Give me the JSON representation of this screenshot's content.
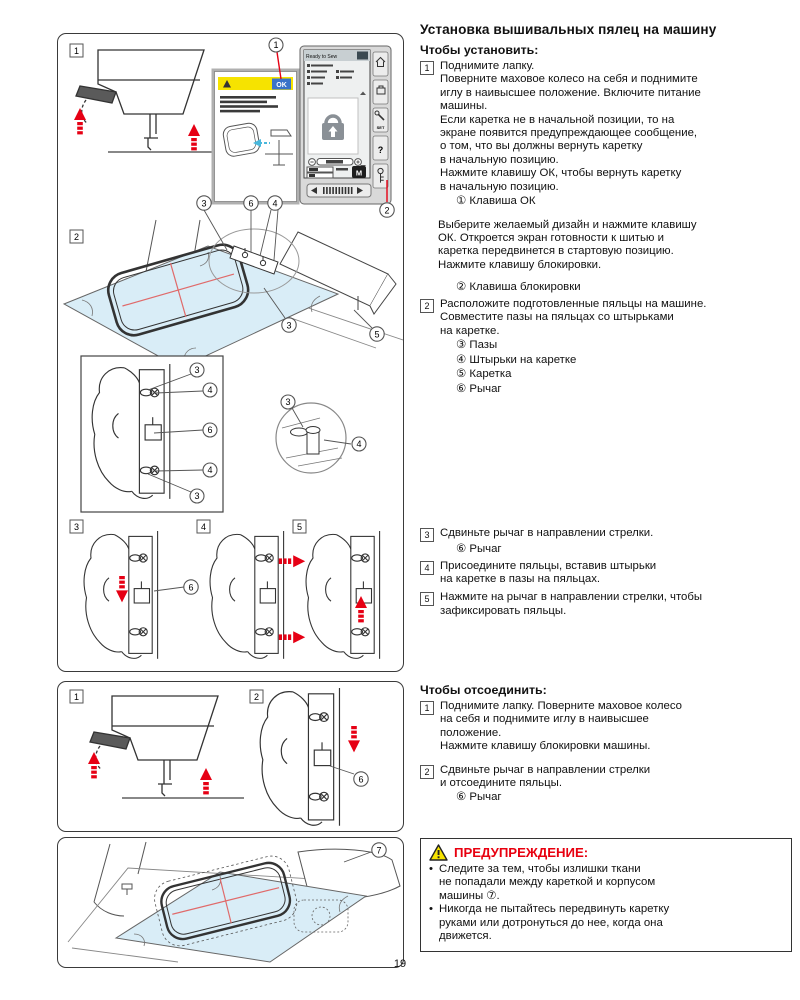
{
  "page_number": "19",
  "title": "Установка вышивальных пялец на машину",
  "install": {
    "heading": "Чтобы установить:",
    "step1_num": "1",
    "step1_text": "Поднимите лапку.\nПоверните маховое колесо на себя и поднимите\nиглу в наивысшее положение. Включите питание\nмашины.\nЕсли каретка не в начальной позиции, то на\nэкране появится предупреждающее сообщение,\nо том, что вы должны вернуть каретку\nв начальную позицию.\nНажмите клавишу ОК, чтобы вернуть каретку\nв начальную позицию.",
    "step1_callout": "① Клавиша ОК",
    "para_ok": "Выберите желаемый дизайн и нажмите клавишу\nОК. Откроется экран готовности к шитью и\nкаретка передвинется в стартовую позицию.\nНажмите клавишу блокировки.",
    "callout_lock": "② Клавиша блокировки",
    "step2_num": "2",
    "step2_text": "Расположите подготовленные пяльцы на машине.\nСовместите пазы на пяльцах со штырьками\nна каретке.",
    "step2_callouts": [
      "③ Пазы",
      "④ Штырьки на каретке",
      "⑤ Каретка",
      "⑥ Рычаг"
    ],
    "step3_num": "3",
    "step3_text": "Сдвиньте рычаг в направлении стрелки.",
    "step3_callout": "⑥ Рычаг",
    "step4_num": "4",
    "step4_text": "Присоедините пяльцы, вставив штырьки\nна каретке в пазы на пяльцах.",
    "step5_num": "5",
    "step5_text": "Нажмите на рычаг в направлении стрелки, чтобы\nзафиксировать пяльцы."
  },
  "detach": {
    "heading": "Чтобы отсоединить:",
    "step1_num": "1",
    "step1_text": "Поднимите лапку. Поверните маховое колесо\nна себя и поднимите иглу в наивысшее\nположение.\nНажмите клавишу блокировки машины.",
    "step2_num": "2",
    "step2_text": "Сдвиньте рычаг в направлении стрелки\nи отсоедините пяльцы.",
    "step2_callout": "⑥ Рычаг"
  },
  "warning": {
    "title": "ПРЕДУПРЕЖДЕНИЕ:",
    "bullets": [
      "Следите за тем, чтобы излишки ткани\nне попадали между кареткой и корпусом\nмашины ⑦.",
      "Никогда не пытайтесь передвинуть каретку\nруками или дотронуться до нее, когда она\nдвижется."
    ]
  },
  "fig": {
    "s1": "1",
    "s2": "2",
    "s3": "3",
    "s4": "4",
    "s5": "5",
    "c1": "1",
    "c2": "2",
    "c3": "3",
    "c4": "4",
    "c5": "5",
    "c6": "6",
    "c7": "7",
    "ok": "OK",
    "ready": "Ready to Sew",
    "set": "SET",
    "help": "?",
    "m": "M"
  },
  "colors": {
    "accent_red": "#e60014",
    "fabric_blue": "#d9edf7",
    "warning_yellow": "#f6e300",
    "ok_blue": "#3a72c8"
  }
}
